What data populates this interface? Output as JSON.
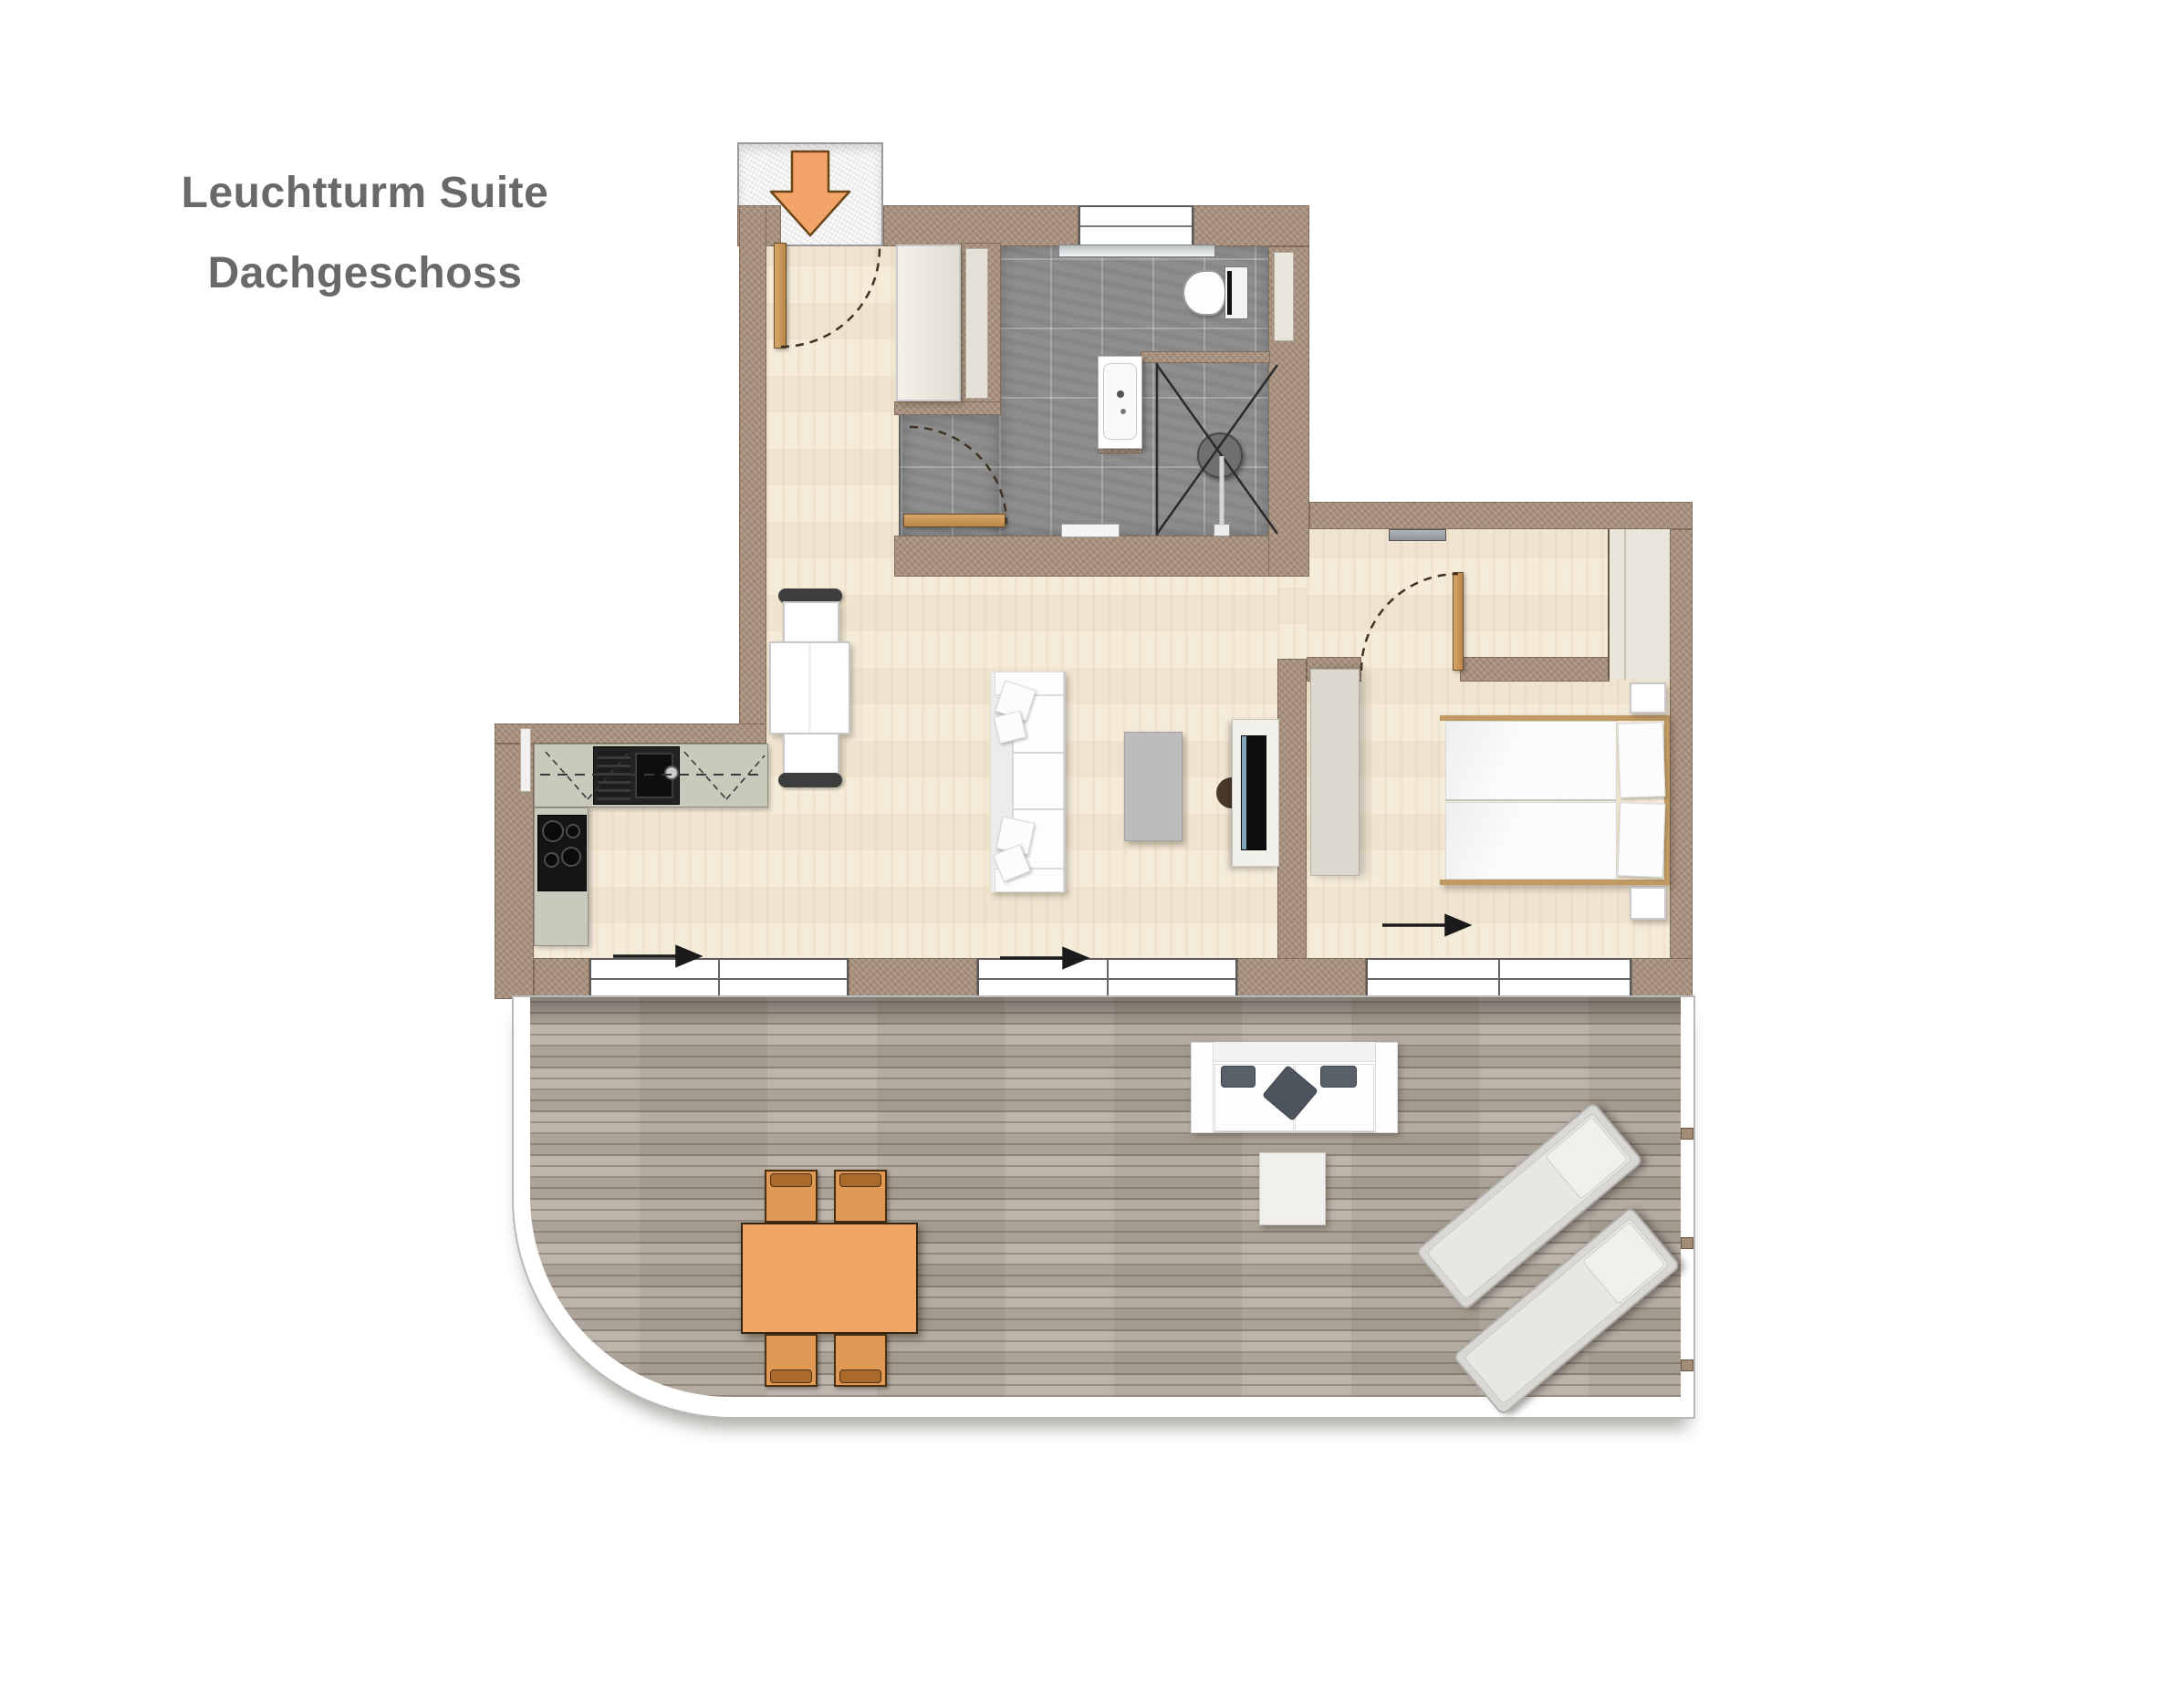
{
  "title": {
    "line1": "Leuchtturm Suite",
    "line2": "Dachgeschoss"
  },
  "colors": {
    "wall": "#a6907d",
    "wood": "#f4ead7",
    "tile": "#8e8e8e",
    "deck": "#b2a89c",
    "railing": "#ffffff",
    "accent": "#f2a469",
    "accent_outline": "#6b4518",
    "counter": "#c9cabc",
    "furniture_orange": "#efa566",
    "chair_orange": "#e09a55",
    "title_text": "#696969",
    "arc": "#3f3323",
    "arrow": "#1a1a1a"
  },
  "icons": {
    "entry_arrow": "entry-arrow-down-icon",
    "flow_arrow": "direction-arrow-right-icon",
    "door_swing": "door-swing-arc"
  }
}
